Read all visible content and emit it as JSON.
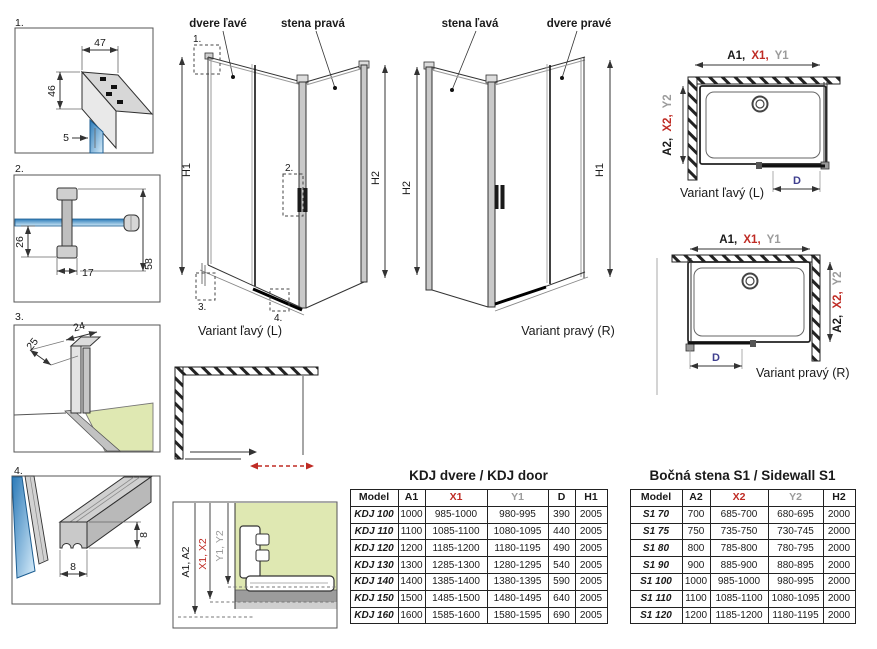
{
  "colors": {
    "red": "#bf2b24",
    "gray": "#9b9b9b",
    "blue": "#3f3f8f",
    "green": "#dfe8b2",
    "glass_blue": "#2b7ab8"
  },
  "details": {
    "d1": {
      "num": "1.",
      "dims": {
        "top": "47",
        "side": "46",
        "glass": "5"
      }
    },
    "d2": {
      "num": "2.",
      "dims": {
        "offset": "26",
        "width": "17",
        "height": "58"
      }
    },
    "d3": {
      "num": "3.",
      "dims": {
        "depth": "25",
        "width": "24"
      }
    },
    "d4": {
      "num": "4.",
      "dims": {
        "height": "8",
        "width": "8"
      }
    }
  },
  "iso_left": {
    "door_label": "dvere ľavé",
    "wall_label": "stena pravá",
    "h_left": "H1",
    "h_right": "H2",
    "caption": "Variant ľavý (L)",
    "markers": {
      "m1": "1.",
      "m2": "2.",
      "m3": "3.",
      "m4": "4."
    }
  },
  "iso_right": {
    "wall_label": "stena ľavá",
    "door_label": "dvere pravé",
    "h_left": "H2",
    "h_right": "H1",
    "caption": "Variant pravý (R)"
  },
  "plan_left": {
    "top_dim": {
      "a": "A1,",
      "x": "X1,",
      "y": "Y1"
    },
    "side_dim": {
      "a": "A2,",
      "x": "X2,",
      "y": "Y2"
    },
    "d_label": "D",
    "caption": "Variant ľavý (L)"
  },
  "plan_right": {
    "top_dim": {
      "a": "A1,",
      "x": "X1,",
      "y": "Y1"
    },
    "side_dim": {
      "a": "A2,",
      "x": "X2,",
      "y": "Y2"
    },
    "d_label": "D",
    "caption": "Variant pravý (R)"
  },
  "adjust_profile": {
    "a": "A1, A2",
    "x": "X1, X2",
    "y": "Y1, Y2"
  },
  "door_table": {
    "title": "KDJ dvere / KDJ door",
    "headers": [
      "Model",
      "A1",
      "X1",
      "Y1",
      "D",
      "H1"
    ],
    "rows": [
      [
        "KDJ 100",
        "1000",
        "985-1000",
        "980-995",
        "390",
        "2005"
      ],
      [
        "KDJ 110",
        "1100",
        "1085-1100",
        "1080-1095",
        "440",
        "2005"
      ],
      [
        "KDJ 120",
        "1200",
        "1185-1200",
        "1180-1195",
        "490",
        "2005"
      ],
      [
        "KDJ 130",
        "1300",
        "1285-1300",
        "1280-1295",
        "540",
        "2005"
      ],
      [
        "KDJ 140",
        "1400",
        "1385-1400",
        "1380-1395",
        "590",
        "2005"
      ],
      [
        "KDJ 150",
        "1500",
        "1485-1500",
        "1480-1495",
        "640",
        "2005"
      ],
      [
        "KDJ 160",
        "1600",
        "1585-1600",
        "1580-1595",
        "690",
        "2005"
      ]
    ]
  },
  "sidewall_table": {
    "title": "Bočná stena S1 / Sidewall S1",
    "headers": [
      "Model",
      "A2",
      "X2",
      "Y2",
      "H2"
    ],
    "rows": [
      [
        "S1 70",
        "700",
        "685-700",
        "680-695",
        "2000"
      ],
      [
        "S1 75",
        "750",
        "735-750",
        "730-745",
        "2000"
      ],
      [
        "S1 80",
        "800",
        "785-800",
        "780-795",
        "2000"
      ],
      [
        "S1 90",
        "900",
        "885-900",
        "880-895",
        "2000"
      ],
      [
        "S1 100",
        "1000",
        "985-1000",
        "980-995",
        "2000"
      ],
      [
        "S1 110",
        "1100",
        "1085-1100",
        "1080-1095",
        "2000"
      ],
      [
        "S1 120",
        "1200",
        "1185-1200",
        "1180-1195",
        "2000"
      ]
    ]
  }
}
